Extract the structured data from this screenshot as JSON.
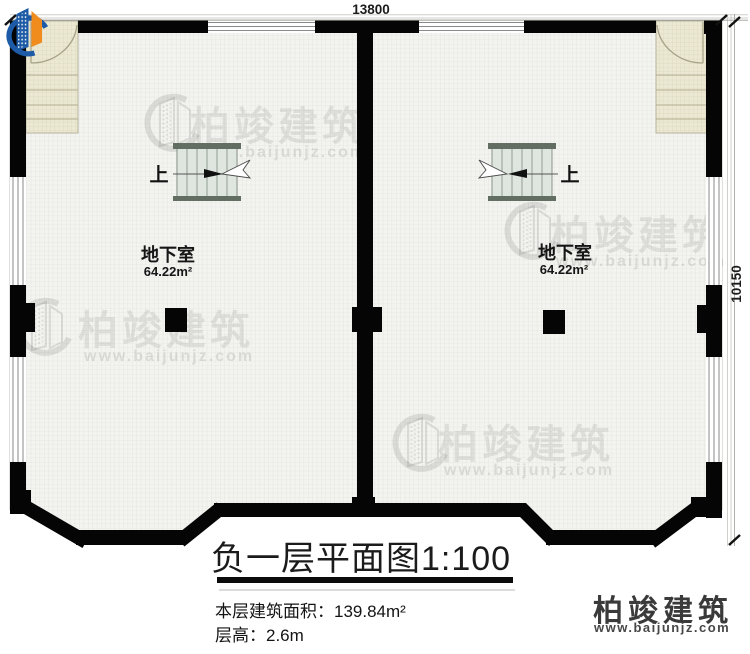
{
  "plan": {
    "dimensions": {
      "top": "13800",
      "right": "10150"
    },
    "rooms": [
      {
        "name": "地下室",
        "area": "64.22m²",
        "stair_label": "上"
      },
      {
        "name": "地下室",
        "area": "64.22m²",
        "stair_label": "上"
      }
    ]
  },
  "watermark": {
    "brand": "柏竣建筑",
    "url": "www.baijunjz.com"
  },
  "title_block": {
    "title": "负一层平面图1:100",
    "area_label": "本层建筑面积：139.84m²",
    "floor_height_label": "层高：2.6m"
  },
  "logo": {
    "brand": "柏竣建筑",
    "url": "www.baijunjz.com"
  },
  "colors": {
    "wall": "#050505",
    "stair_fill": "#dfe5df",
    "entry_fill": "#ebe8d4",
    "logo_blue": "#1d5ba6",
    "logo_orange": "#f08c1e"
  }
}
